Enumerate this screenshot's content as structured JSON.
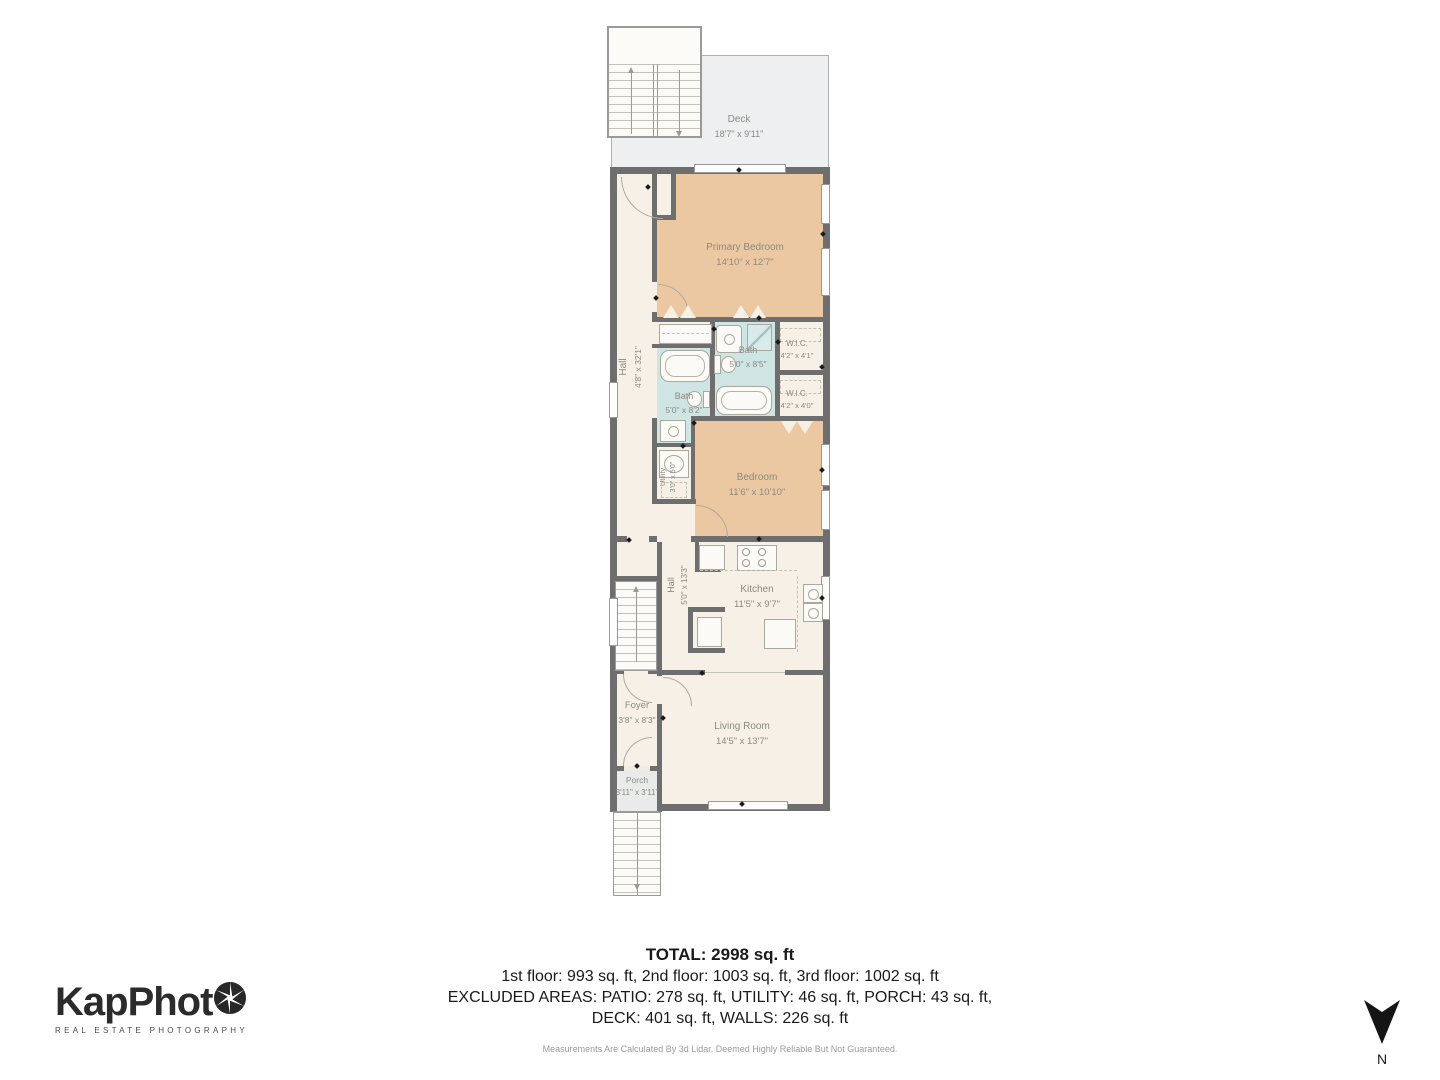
{
  "branding": {
    "logo_text": "KapPhot",
    "tagline": "REAL ESTATE PHOTOGRAPHY"
  },
  "compass": {
    "label": "N"
  },
  "summary": {
    "total": "TOTAL: 2998 sq. ft",
    "floors": "1st floor: 993 sq. ft, 2nd floor: 1003 sq. ft, 3rd floor: 1002 sq. ft",
    "excluded_line1": "EXCLUDED AREAS: PATIO: 278 sq. ft, UTILITY: 46 sq. ft, PORCH: 43 sq. ft,",
    "excluded_line2": "DECK: 401 sq. ft, WALLS: 226 sq. ft",
    "disclaimer": "Measurements Are Calculated By 3d Lidar. Deemed Highly Reliable But Not Guaranteed."
  },
  "rooms": {
    "deck": {
      "name": "Deck",
      "dims": "18'7\" x 9'11\""
    },
    "primary_bedroom": {
      "name": "Primary Bedroom",
      "dims": "14'10\" x 12'7\""
    },
    "hall_upper": {
      "name": "Hall",
      "dims": "4'8\" x 32'1\""
    },
    "bath_upper": {
      "name": "Bath",
      "dims": "5'0\" x 8'5\""
    },
    "wic_upper": {
      "name": "W.I.C.",
      "dims": "4'2\" x 4'1\""
    },
    "wic_lower": {
      "name": "W.I.C.",
      "dims": "4'2\" x 4'0\""
    },
    "bath_lower": {
      "name": "Bath",
      "dims": "5'0\" x 8'2\""
    },
    "utility": {
      "name": "Utility",
      "dims": "3'0\" x 5'0\""
    },
    "bedroom": {
      "name": "Bedroom",
      "dims": "11'6\" x 10'10\""
    },
    "hall_lower": {
      "name": "Hall",
      "dims": "5'0\" x 13'3\""
    },
    "kitchen": {
      "name": "Kitchen",
      "dims": "11'5\" x 9'7\""
    },
    "foyer": {
      "name": "Foyer",
      "dims": "3'8\" x 8'3\""
    },
    "living_room": {
      "name": "Living Room",
      "dims": "14'5\" x 13'7\""
    },
    "porch": {
      "name": "Porch",
      "dims": "3'11\" x 3'11\""
    }
  },
  "colors": {
    "wall": "#6e6e6e",
    "floor": "#f6f0e7",
    "bedroom_fill": "#ecc8a2",
    "bath_fill": "#cfe5e4",
    "deck_fill": "#edeff0",
    "label_text": "#8b8b80"
  }
}
